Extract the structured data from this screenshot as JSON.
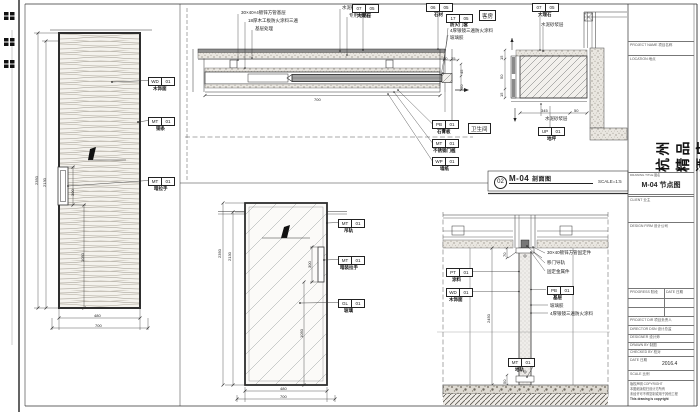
{
  "drawing_label": {
    "number": "02",
    "code": "M-04",
    "name": "剖面图",
    "scale": "SCALE=1:5"
  },
  "elev1": {
    "callouts": [
      {
        "code": "WD",
        "num": "01",
        "label": "木饰面"
      },
      {
        "code": "MT",
        "num": "01",
        "label": "铜条"
      },
      {
        "code": "MT",
        "num": "01",
        "label": "暗拉手"
      }
    ],
    "dims": {
      "height_outer": "2350",
      "height_inner": "2130",
      "handle": "300",
      "to_floor": "1050",
      "leaf": "480",
      "total": "700"
    }
  },
  "detailA": {
    "leaders_left": [
      "30×40×4镀锌方管基层",
      "18厚木工板防火涂料三遍",
      "基层处理"
    ],
    "leaders_mid": [
      "水泥砂浆层",
      "专用粘结层"
    ],
    "callout_1": {
      "code": "07",
      "num": "05",
      "label": "大理石"
    },
    "callout_2": {
      "code": "06",
      "num": "05",
      "label": "石材"
    },
    "callout_3": {
      "code": "17",
      "num": "05",
      "label": "防火门套"
    },
    "leaders_right": [
      "4厚银镜三遍防火涂料",
      "玻璃胶"
    ],
    "room_top": "客房",
    "room_bottom": "卫生间",
    "bottom_callouts": [
      {
        "code": "PB",
        "num": "01",
        "label": "石膏板"
      },
      {
        "code": "MT",
        "num": "01",
        "label": "不锈钢门槛"
      },
      {
        "code": "WP",
        "num": "01",
        "label": "墙纸"
      }
    ],
    "dims": {
      "pocket": "700",
      "d1": "20",
      "d2": "25",
      "d3": "45",
      "d4": "50"
    }
  },
  "detailB": {
    "callout_top": {
      "code": "07",
      "num": "05",
      "label": "大理石"
    },
    "leader_top": "水泥砂浆层",
    "leader_bottom": "水泥砂浆层",
    "callout_bottom": {
      "code": "UP",
      "num": "01",
      "label": "地坪"
    },
    "dims": {
      "s1": "15",
      "s2": "50",
      "s3": "15",
      "bottom_main": "345",
      "bottom_side": "50"
    }
  },
  "detailC": {
    "callouts": [
      {
        "code": "MT",
        "num": "01",
        "label": "吊轨"
      },
      {
        "code": "MT",
        "num": "01",
        "label": "暗装拉手"
      },
      {
        "code": "GL",
        "num": "01",
        "label": "玻璃"
      }
    ],
    "dims": {
      "height_outer": "2350",
      "height_inner": "2130",
      "handle": "300",
      "to_floor": "1050",
      "leaf": "480",
      "total": "700"
    }
  },
  "detailD": {
    "leaders_right": [
      "30×40镀锌方管固定件",
      "移门导轨",
      "固定金属件"
    ],
    "callout_right": {
      "code": "PB",
      "num": "01",
      "label": "基层"
    },
    "leaders_mid": [
      "玻璃胶",
      "4厚银镜三遍防火涂料"
    ],
    "callouts_left": [
      {
        "code": "PT",
        "num": "01",
        "label": "涂料"
      },
      {
        "code": "WD",
        "num": "01",
        "label": "木饰面"
      }
    ],
    "callout_bottom": {
      "code": "MT",
      "num": "01",
      "label": "地轨"
    },
    "dims": {
      "height": "2450",
      "top": "70",
      "bottom": "50"
    }
  },
  "title_block": {
    "top_row1": "PROJECT NAME 项目名称",
    "top_row2": "LOCATION 地点",
    "project_name": "杭州精品酒店",
    "sheet_label": "DRAWING TITLE 图名",
    "sheet_name": "M-04 节点图",
    "client_label": "CLIENT 业主",
    "firm_label": "DESIGN FIRM 设计公司",
    "progress_label": "PROGRESS 阶段",
    "date_col_label": "DATE 日期",
    "staff_rows": [
      "PROJECT DIR 项目负责人",
      "DIRECTOR DSN 设计总监",
      "DESIGNER 设计师",
      "DRAWN BY 制图",
      "CHECKED BY 校对"
    ],
    "date_row_label": "DATE 日期",
    "date_value": "2016.4",
    "scale_row_label": "SCALE 比例",
    "scale_value": "",
    "notes": [
      "版权声明 COPYRIGHT",
      "本图纸版权归设计方所有",
      "未经许可不得复制或用于其他工程",
      "This drawing is copyright"
    ]
  },
  "colors": {
    "line": "#333333",
    "paper": "#ffffff",
    "marble_gray": "#8c8c8c",
    "leaf_gray": "#a3a3a3"
  }
}
